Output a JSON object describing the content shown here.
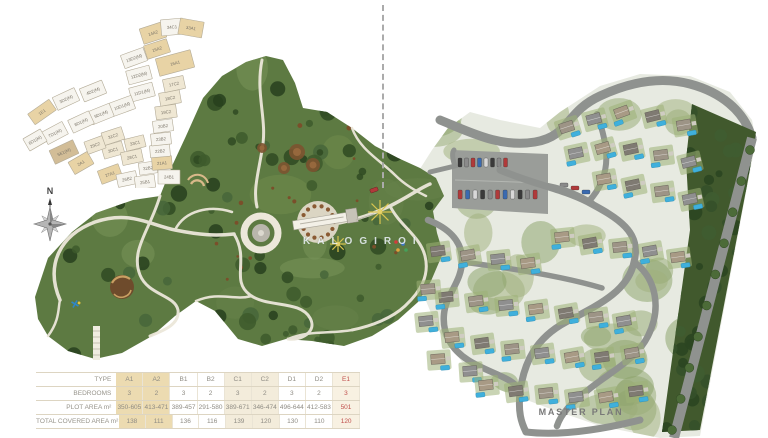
{
  "page": {
    "caption": "MASTER PLAN",
    "watermark": "KALOGIROI",
    "background": "#ffffff"
  },
  "compass": {
    "north_label": "N"
  },
  "legend_table": {
    "row_labels": [
      "TYPE",
      "BEDROOMS",
      "PLOT AREA m²",
      "TOTAL COVERED AREA m²"
    ],
    "columns": [
      "A1",
      "A2",
      "B1",
      "B2",
      "C1",
      "C2",
      "D1",
      "D2",
      "E1"
    ],
    "column_styles": [
      "tan",
      "tan",
      "plain",
      "plain",
      "cream",
      "cream",
      "plain",
      "plain",
      "accent"
    ],
    "rows": [
      {
        "label": "BEDROOMS",
        "values": [
          "3",
          "2",
          "3",
          "2",
          "3",
          "2",
          "3",
          "2",
          "3"
        ]
      },
      {
        "label": "PLOT AREA m²",
        "values": [
          "350-605",
          "413-471",
          "389-457",
          "291-580",
          "389-671",
          "346-474",
          "496-644",
          "412-583",
          "501"
        ]
      },
      {
        "label": "TOTAL COVERED AREA m²",
        "values": [
          "138",
          "111",
          "136",
          "116",
          "139",
          "120",
          "130",
          "110",
          "120"
        ]
      }
    ],
    "colors": {
      "tan": "#ecdbb1",
      "cream": "#f3ecdb",
      "accent_bg": "#f8f1e2",
      "accent_text": "#c0504d",
      "text": "#8f8c84",
      "grid": "#ddd5c2"
    }
  },
  "parcel_map": {
    "fills": {
      "tan": "#e8d3a5",
      "dark": "#d2bd97",
      "white": "#f6f4ee",
      "cream": "#efe7d3",
      "stroke": "#b3ab97",
      "label": "#7a7468"
    },
    "parcels": [
      {
        "label": "14A2",
        "x": 145,
        "y": 27,
        "rot": -18,
        "w": 24,
        "h": 16,
        "type": "tan"
      },
      {
        "label": "34C1",
        "x": 164,
        "y": 21,
        "rot": -5,
        "w": 22,
        "h": 16,
        "type": "white"
      },
      {
        "label": "33A1",
        "x": 183,
        "y": 22,
        "rot": 10,
        "w": 24,
        "h": 16,
        "type": "tan"
      },
      {
        "label": "15A2",
        "x": 149,
        "y": 43,
        "rot": -18,
        "w": 24,
        "h": 14,
        "type": "tan"
      },
      {
        "label": "16A1",
        "x": 167,
        "y": 57,
        "rot": -15,
        "w": 36,
        "h": 18,
        "type": "tan"
      },
      {
        "label": "13D2(M)",
        "x": 126,
        "y": 52,
        "rot": -20,
        "w": 24,
        "h": 14,
        "type": "white"
      },
      {
        "label": "12D2(M)",
        "x": 131,
        "y": 69,
        "rot": -15,
        "w": 24,
        "h": 14,
        "type": "white"
      },
      {
        "label": "11D1(M)",
        "x": 134,
        "y": 86,
        "rot": -15,
        "w": 24,
        "h": 14,
        "type": "white"
      },
      {
        "label": "10D1(M)",
        "x": 114,
        "y": 100,
        "rot": -20,
        "w": 24,
        "h": 14,
        "type": "white"
      },
      {
        "label": "9D1(M)",
        "x": 93,
        "y": 108,
        "rot": -22,
        "w": 23,
        "h": 14,
        "type": "white"
      },
      {
        "label": "8D1(M)",
        "x": 73,
        "y": 116,
        "rot": -25,
        "w": 23,
        "h": 14,
        "type": "white"
      },
      {
        "label": "7D1(M)",
        "x": 47,
        "y": 127,
        "rot": -28,
        "w": 23,
        "h": 14,
        "type": "white"
      },
      {
        "label": "6D1(M)",
        "x": 27,
        "y": 134,
        "rot": -30,
        "w": 20,
        "h": 14,
        "type": "white"
      },
      {
        "label": "4D2(M)",
        "x": 85,
        "y": 85,
        "rot": -22,
        "w": 24,
        "h": 14,
        "type": "white"
      },
      {
        "label": "3D2(M)",
        "x": 58,
        "y": 93,
        "rot": -25,
        "w": 24,
        "h": 14,
        "type": "white"
      },
      {
        "label": "1E1",
        "x": 34,
        "y": 106,
        "rot": -35,
        "w": 26,
        "h": 13,
        "type": "tan"
      },
      {
        "label": "5E1(M)",
        "x": 56,
        "y": 146,
        "rot": -25,
        "w": 26,
        "h": 15,
        "type": "dark"
      },
      {
        "label": "2A1",
        "x": 73,
        "y": 157,
        "rot": -30,
        "w": 22,
        "h": 14,
        "type": "tan"
      },
      {
        "label": "27A1",
        "x": 102,
        "y": 168,
        "rot": -20,
        "w": 22,
        "h": 14,
        "type": "tan"
      },
      {
        "label": "26B2",
        "x": 119,
        "y": 173,
        "rot": -12,
        "w": 20,
        "h": 13,
        "type": "white"
      },
      {
        "label": "25B1",
        "x": 137,
        "y": 176,
        "rot": -8,
        "w": 20,
        "h": 13,
        "type": "white"
      },
      {
        "label": "24B1",
        "x": 161,
        "y": 171,
        "rot": 0,
        "w": 22,
        "h": 14,
        "type": "white"
      },
      {
        "label": "32B2",
        "x": 140,
        "y": 162,
        "rot": -8,
        "w": 18,
        "h": 12,
        "type": "white"
      },
      {
        "label": "21A1",
        "x": 154,
        "y": 157,
        "rot": -5,
        "w": 20,
        "h": 13,
        "type": "tan"
      },
      {
        "label": "22B2",
        "x": 152,
        "y": 145,
        "rot": -5,
        "w": 20,
        "h": 12,
        "type": "white"
      },
      {
        "label": "23B2",
        "x": 153,
        "y": 133,
        "rot": -6,
        "w": 20,
        "h": 12,
        "type": "white"
      },
      {
        "label": "20B2",
        "x": 155,
        "y": 120,
        "rot": -8,
        "w": 20,
        "h": 12,
        "type": "white"
      },
      {
        "label": "19C2",
        "x": 158,
        "y": 106,
        "rot": -8,
        "w": 21,
        "h": 13,
        "type": "cream"
      },
      {
        "label": "18C2",
        "x": 162,
        "y": 92,
        "rot": -10,
        "w": 21,
        "h": 13,
        "type": "cream"
      },
      {
        "label": "17C2",
        "x": 166,
        "y": 78,
        "rot": -12,
        "w": 21,
        "h": 13,
        "type": "cream"
      },
      {
        "label": "31C2",
        "x": 105,
        "y": 130,
        "rot": -18,
        "w": 21,
        "h": 13,
        "type": "cream"
      },
      {
        "label": "30C1",
        "x": 105,
        "y": 144,
        "rot": -16,
        "w": 21,
        "h": 13,
        "type": "cream"
      },
      {
        "label": "29C2",
        "x": 87,
        "y": 139,
        "rot": -20,
        "w": 19,
        "h": 13,
        "type": "cream"
      },
      {
        "label": "28C1",
        "x": 124,
        "y": 151,
        "rot": -12,
        "w": 21,
        "h": 13,
        "type": "cream"
      },
      {
        "label": "33C1",
        "x": 127,
        "y": 137,
        "rot": -14,
        "w": 20,
        "h": 12,
        "type": "cream"
      }
    ]
  }
}
